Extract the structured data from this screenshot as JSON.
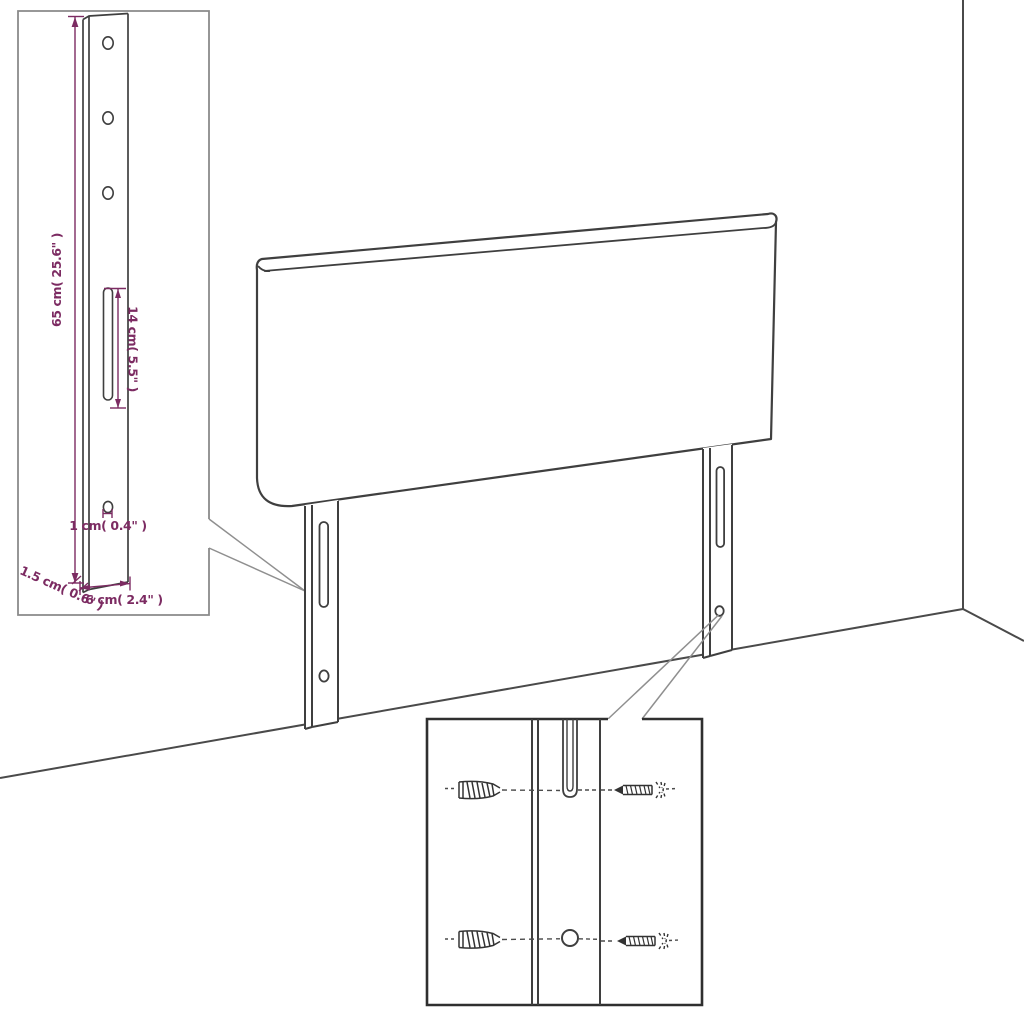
{
  "diagram": {
    "subject": "headboard wall-mounting assembly diagram",
    "line_color": "#3f3f3f",
    "dimension_color": "#7c2b62",
    "background_color": "#ffffff"
  },
  "dimensions": {
    "leg_height": "65 cm( 25.6\" )",
    "slot_length": "14 cm( 5.5\" )",
    "hole_size": "1 cm( 0.4\" )",
    "leg_thickness": "1.5 cm( 0.6\" )",
    "leg_width": "6 cm( 2.4\" )"
  }
}
